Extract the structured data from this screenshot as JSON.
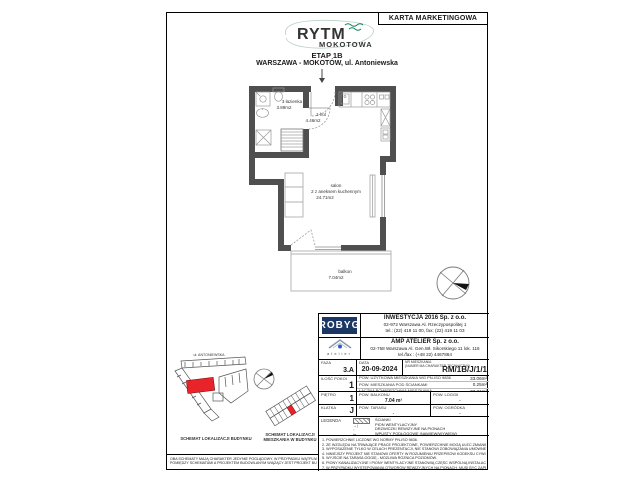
{
  "card": {
    "corner_label": "KARTA MARKETINGOWA"
  },
  "header": {
    "brand_line1": "RYTM",
    "brand_line2": "MOKOTOWA",
    "stage": "ETAP 1B",
    "location": "WARSZAWA - MOKOTÓW, ul. Antoniewska"
  },
  "floorplan": {
    "rooms": {
      "bathroom": {
        "name": "3 łazienka",
        "area": "3.89m2"
      },
      "hall": {
        "name": "1 hol",
        "area": "4.46m2"
      },
      "living": {
        "name1": "salon",
        "name2": "2 z aneksem kuchennym",
        "area": "24.71m2"
      },
      "balcony": {
        "name": "balkon",
        "area": "7.04m2"
      }
    }
  },
  "schematics": {
    "street": "ul. ANTONIEWSKA",
    "building_caption": "SCHEMAT LOKALIZACJI BUDYNKU",
    "unit_caption_line1": "SCHEMAT LOKALIZACJI",
    "unit_caption_line2": "MIESZKANIA W BUDYNKU",
    "note_line1": "OBA SCHEMATY MAJĄ CHARAKTER JEDYNIE POGLĄDOWY. W PRZYPADKU WĄTPLIWOŚCI/WYSTĄPIENIA ROZBIEŻNOŚCI",
    "note_line2": "POMIĘDZY SCHEMATAMI A PROJEKTEM BUDOWLANYM WIĄŻĄCY JEST PROJEKT BUDOWLANY."
  },
  "titleblock": {
    "developer_logo": "ROBYG",
    "investor_name": "INWESTYCJA 2016 Sp. z o.o.",
    "investor_address": "02-972 Warszawa Al. Rzeczypospolitej 1",
    "investor_phone": "tel.: (22) 419 11 00, fax: (22) 419 11 03",
    "studio_logo": "atelier",
    "studio_name": "AMP ATELIER Sp. z o.o.",
    "studio_address": "02-758 Warszawa  Al. Gen.Wł. Sikorskiego 11 lok. 116",
    "studio_phone": "tel./fax : (+48 22) 4467864",
    "faza_label": "FAZA",
    "faza_value": "3.A",
    "data_label": "DATA",
    "data_value": "20-09-2024",
    "nr_label": "NR MIESZKANIA",
    "nr_sublabel": "(NUMER MA CHARAKTER TECHNICZNY)",
    "nr_value": "RM/1B/J/1/1",
    "rooms_label": "ILOŚĆ POKOI",
    "rooms_value": "1",
    "area_rows": [
      {
        "label": "POW. UŻYTKOWA MIESZKANIA WG PN-ISO 9836",
        "value": "33.06m²"
      },
      {
        "label": "POW. MIESZKANIA POD ŚCIANKAMI",
        "value": "0.25m²"
      },
      {
        "label": "ŁĄCZNA POWIERZCHNIA MIESZKANIA",
        "value": "33.31m²"
      }
    ],
    "pietro_label": "PIĘTRO",
    "pietro_value": "1",
    "balkon_label": "POW. BALKONU",
    "balkon_value": "7.04 m²",
    "loggia_label": "POW. LOGGII",
    "loggia_value": "-",
    "klatka_label": "KLATKA",
    "klatka_value": "J",
    "taras_label": "POW. TARASU",
    "taras_value": "-",
    "ogrodek_label": "POW. OGRÓDKA",
    "ogrodek_value": "-"
  },
  "legend": {
    "label": "LEGENDA",
    "items": [
      {
        "text": "ŚCIANKI"
      },
      {
        "text": "PION WENTYLACYJNY"
      },
      {
        "text": "DRZWICZKI REWIZYJNE NA PIONACH"
      },
      {
        "text": "WPUSTY PODŁOGOWE (NAWIEW/WYWIEW)"
      }
    ],
    "notes": [
      "1. POWIERZCHNIE LICZONE WG NORMY PN-ISO 9836.",
      "2. ZE WZGLĘDU NA TRWAJĄCE PRACE PROJEKTOWE, POWIERZCHNIE MOGĄ ULEC ZMIANIE.",
      "3. WYPOSAŻENIE TYLKO W CELACH PREZENTACJI, NIE STANOWI ZOBOWIĄZANIA UMOWNEGO.",
      "4. NINIEJSZY PROJEKT NIE STANOWI OFERTY W ROZUMIENIU PRZEPISÓW KODEKSU CYWILNEGO.",
      "5. WYJŚCIE NA TARAS/LOGGIĘ - MOŻLIWA RÓŻNICA POZIOMÓW.",
      "6. PIONY KANALIZACYJNE I PIONY WENTYLACYJNE STANOWIĄ CZĘŚĆ WSPÓLNĄ INSTALACJI BUDYNKU.",
      "7. W PRZYPADKU WYSTĘPOWANIA OTWORÓW REWIZYJNYCH NA PIONACH, MUSI BYĆ ZAPEWNIONY DOSTĘP DO NICH ZGODNIE Z DOKUMENTACJĄ TECHNICZNĄ."
    ]
  }
}
